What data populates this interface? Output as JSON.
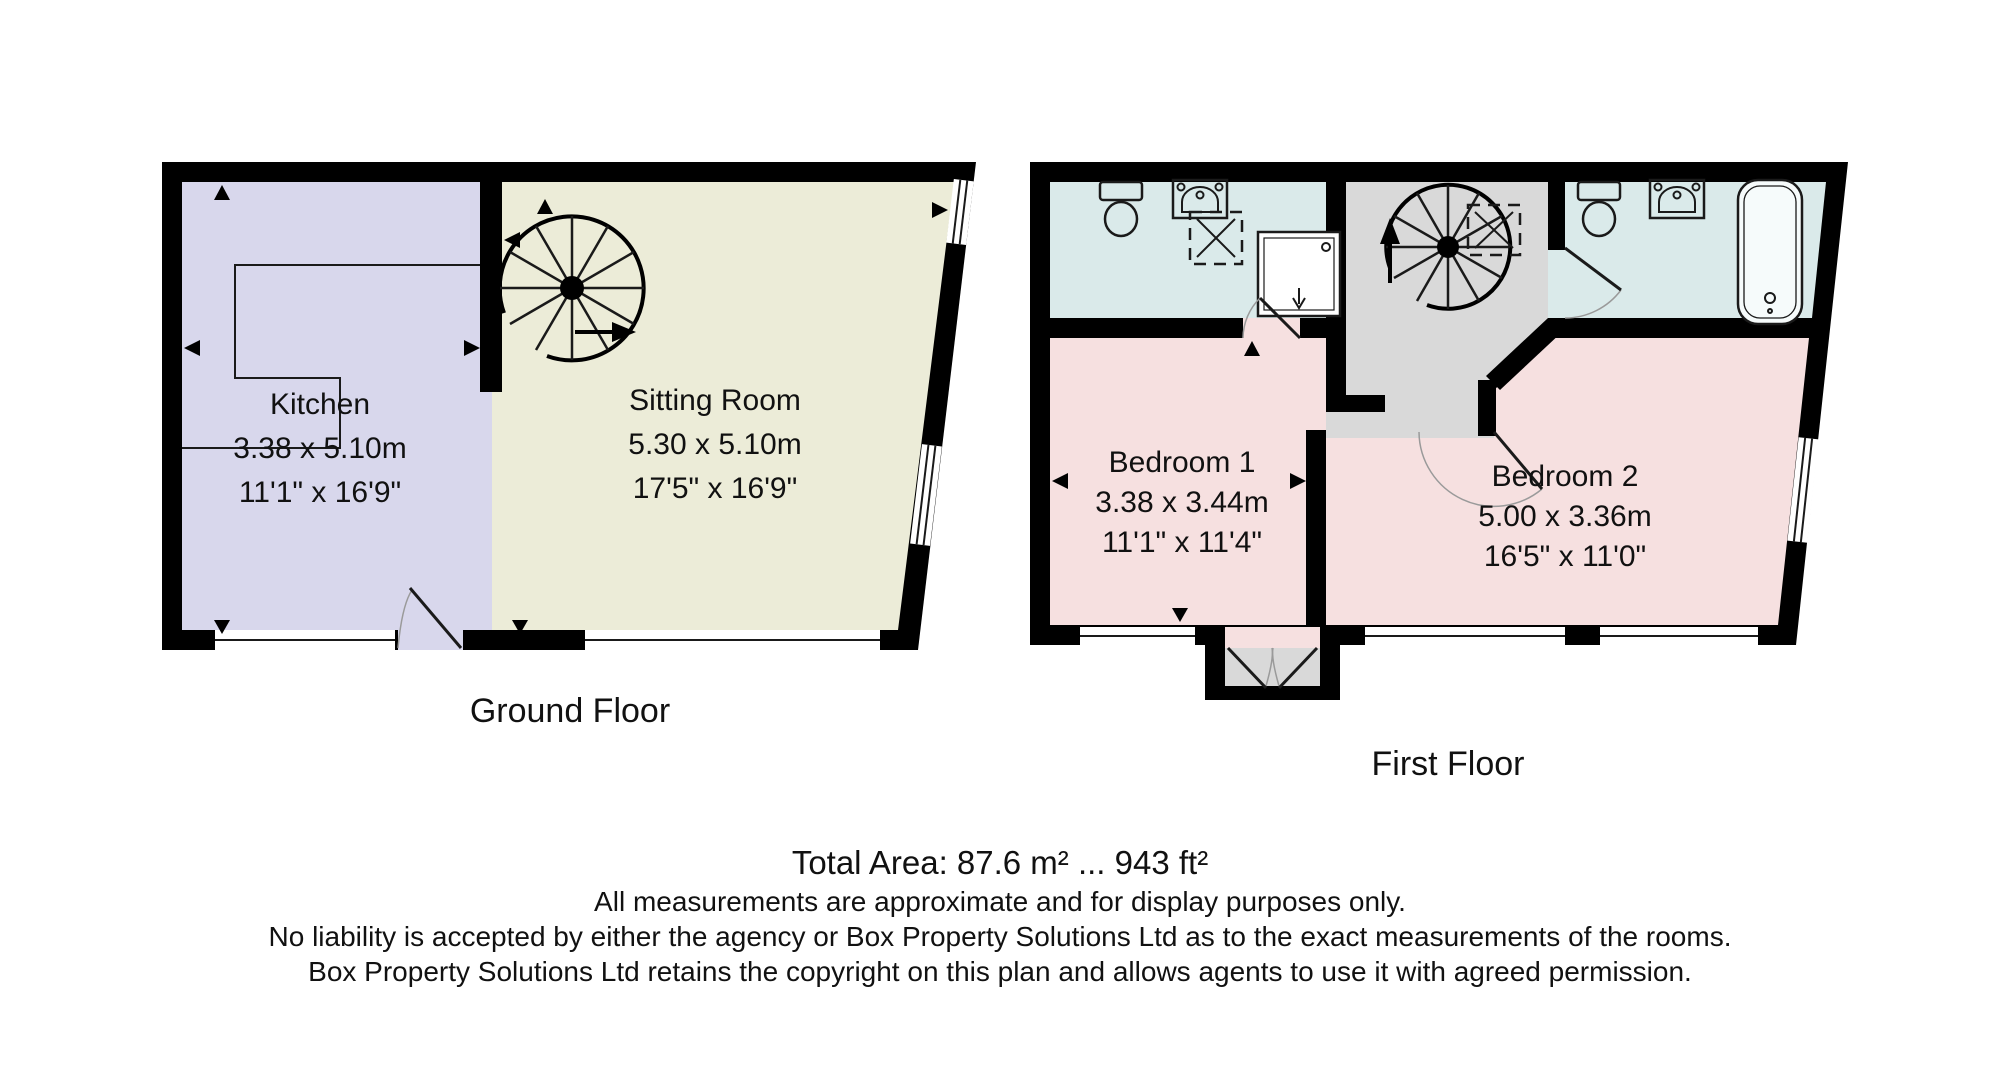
{
  "colors": {
    "wall": "#000000",
    "kitchen": "#d8d7ec",
    "sitting_room": "#ececd8",
    "bathroom": "#daeaea",
    "bedroom": "#f6e0e0",
    "stairs": "#d9d9d9",
    "window": "#ffffff",
    "text": "#111111"
  },
  "ground_floor": {
    "caption": "Ground Floor",
    "kitchen": {
      "name": "Kitchen",
      "dims_metric": "3.38 x 5.10m",
      "dims_imperial": "11'1\" x 16'9\""
    },
    "sitting_room": {
      "name": "Sitting Room",
      "dims_metric": "5.30 x 5.10m",
      "dims_imperial": "17'5\" x 16'9\""
    }
  },
  "first_floor": {
    "caption": "First Floor",
    "bedroom1": {
      "name": "Bedroom 1",
      "dims_metric": "3.38 x 3.44m",
      "dims_imperial": "11'1\" x 11'4\""
    },
    "bedroom2": {
      "name": "Bedroom 2",
      "dims_metric": "5.00 x 3.36m",
      "dims_imperial": "16'5\" x 11'0\""
    }
  },
  "icons": {
    "spiral_staircase": "spiral-staircase",
    "toilet": "toilet",
    "sink": "sink",
    "shower": "shower",
    "shower_enclosure": "shower-enclosure",
    "bathtub": "bathtub",
    "kitchen_counter": "kitchen-counter"
  },
  "footer": {
    "total_area": "Total Area: 87.6 m² ... 943 ft²",
    "line2": "All measurements are approximate and for display purposes only.",
    "line3": "No liability is accepted by either the agency or Box Property Solutions Ltd as to the exact measurements of the rooms.",
    "line4": "Box Property Solutions Ltd retains the copyright on this plan and allows agents to use it with agreed permission."
  }
}
